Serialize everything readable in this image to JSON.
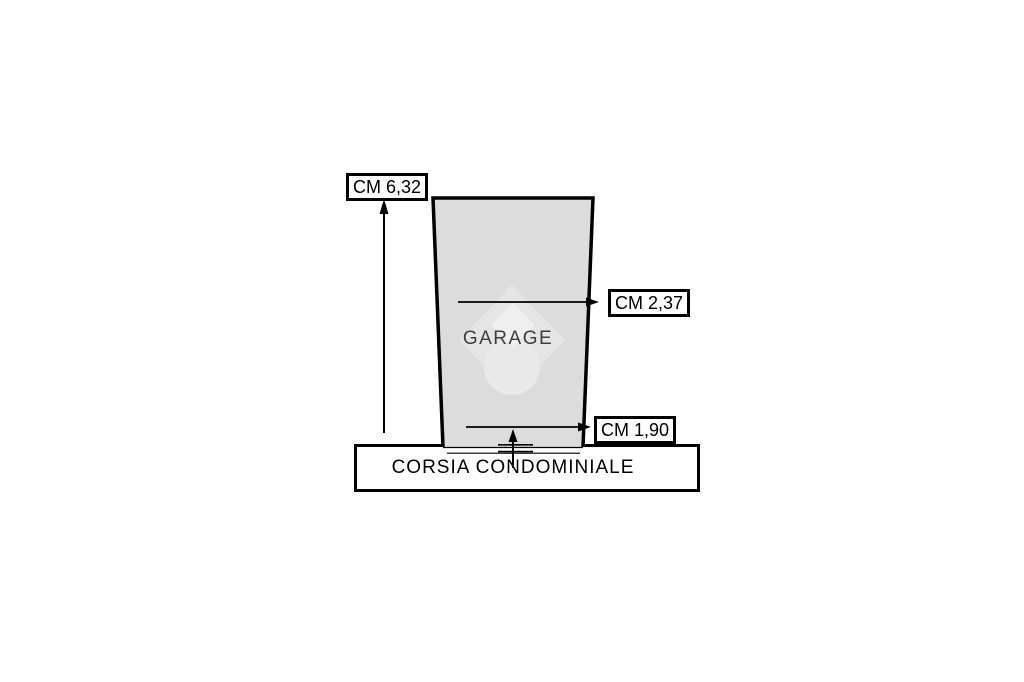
{
  "page": {
    "background_color": "#ffffff"
  },
  "diagram": {
    "garage": {
      "label": "GARAGE",
      "fill_color": "#dcdcdc",
      "text_color": "#3d3d3d"
    },
    "measurements": {
      "height": "CM 6,32",
      "depth_upper": "CM 2,37",
      "depth_lower": "CM 1,90"
    },
    "corsia": {
      "label": "CORSIA CONDOMINIALE"
    },
    "watermark": {
      "icon": "property-portal-pin-logo",
      "diamond_color": "#e5e5e5",
      "inner_diamond_color": "#efefef",
      "circle_color": "#e9e9e9"
    },
    "line_color": "#000000"
  }
}
